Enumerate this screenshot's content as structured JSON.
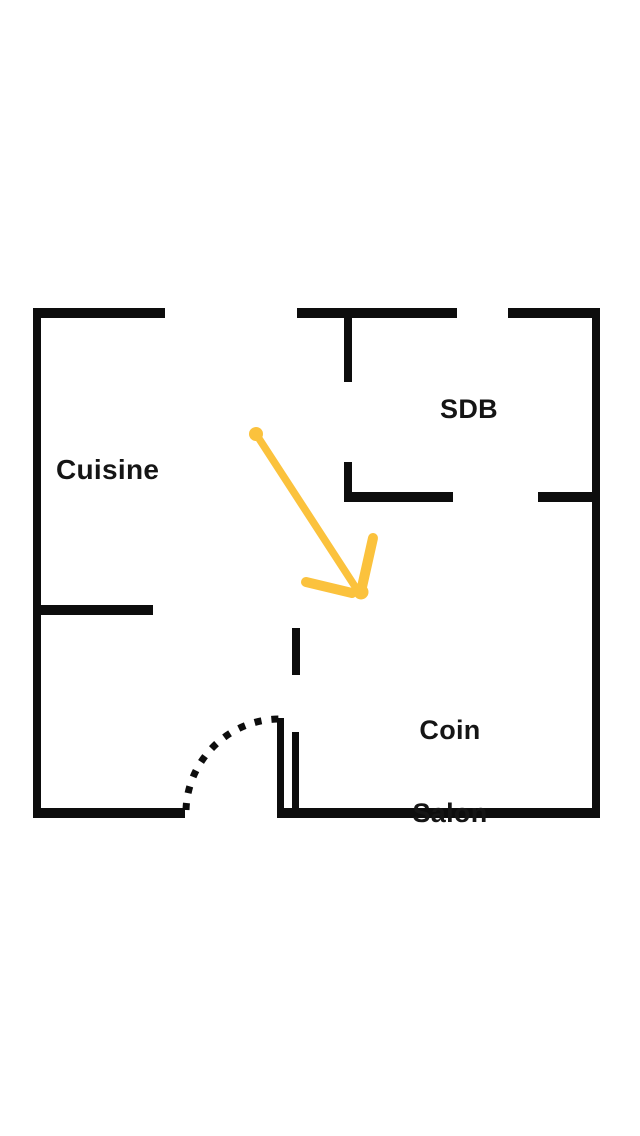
{
  "rooms": {
    "cuisine": {
      "label": "Cuisine"
    },
    "sdb": {
      "label": "SDB"
    },
    "coin_salon": {
      "line1": "Coin",
      "line2": "Salon"
    }
  },
  "annotation_arrow": {
    "name": "hand-drawn-arrow",
    "direction": "down-right",
    "points_to": "hallway between SDB and Coin Salon"
  },
  "colors": {
    "wall": "#0d0d0d",
    "label": "#151515",
    "accent_arrow": "#fbc23d",
    "background": "#ffffff"
  }
}
